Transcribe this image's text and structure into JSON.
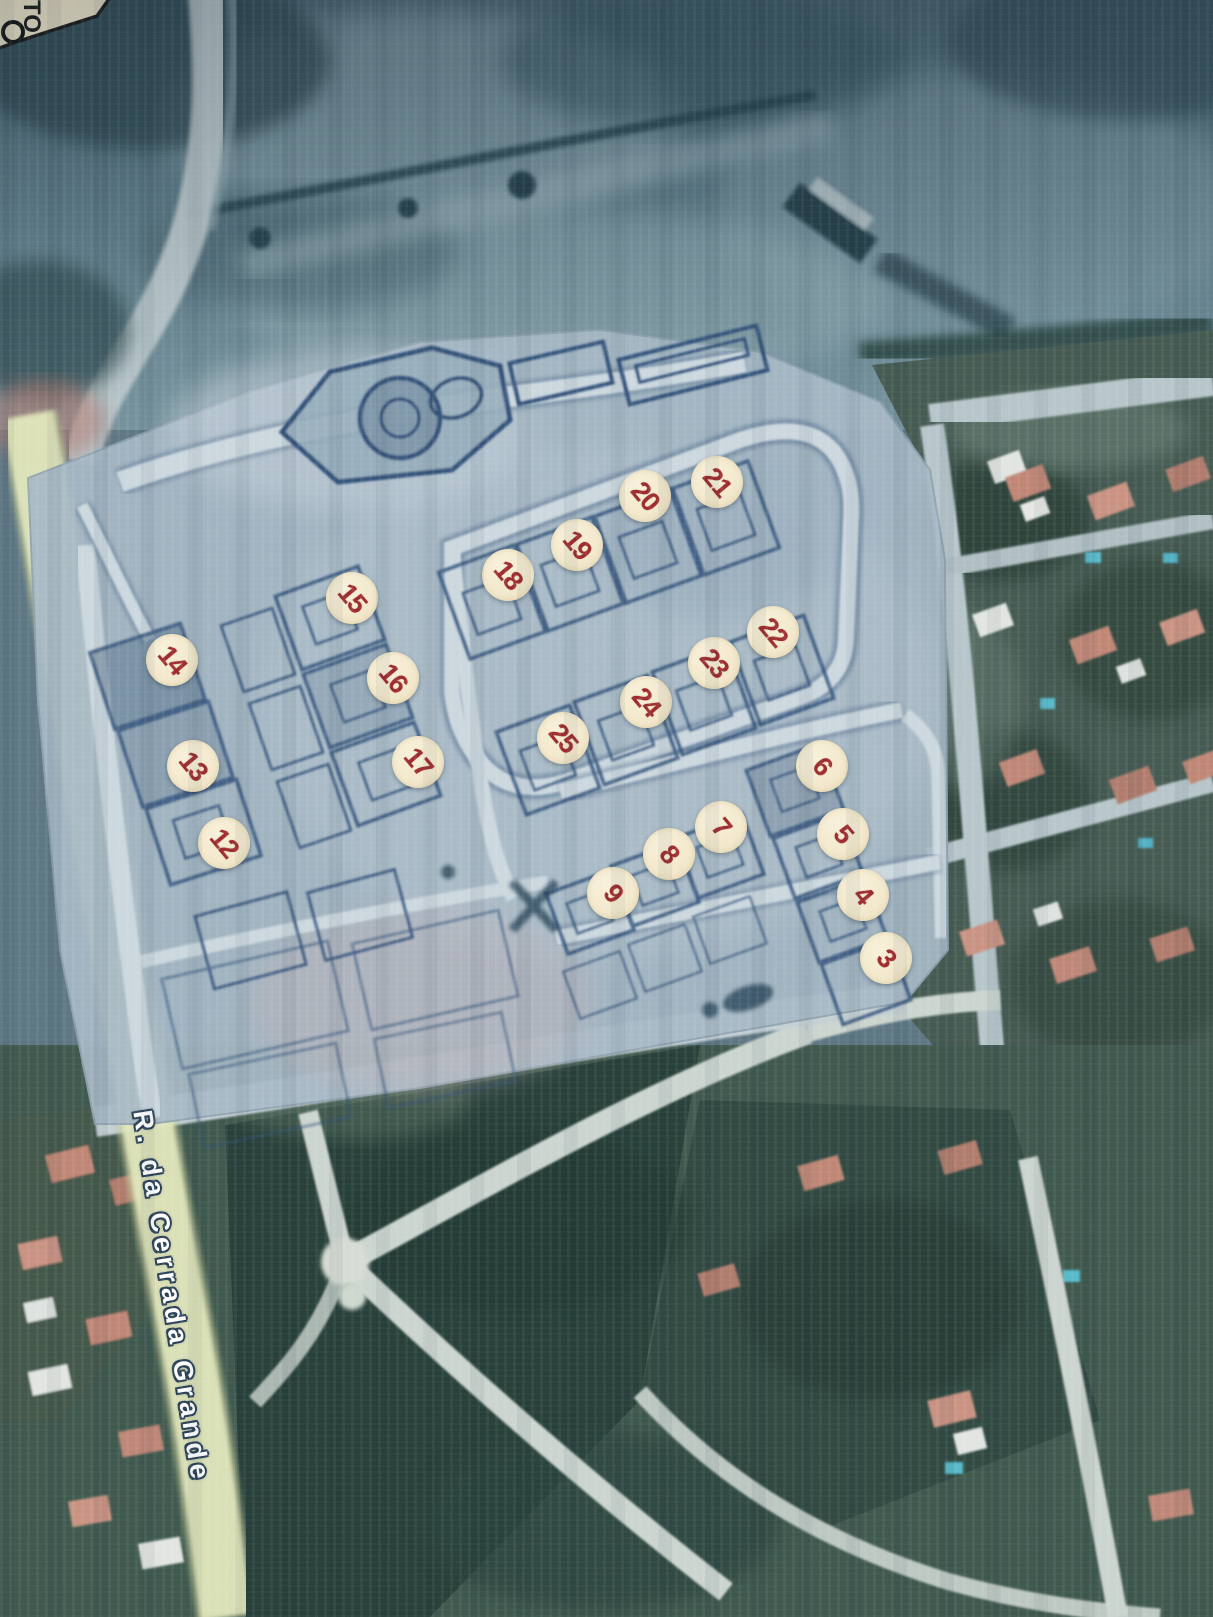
{
  "scene": {
    "description": "photograph of a printed aerial map with a development lot plan overlay and numbered lot stickers",
    "street_label": "R. da Cerrada Grande",
    "corner_text": "TO",
    "markers": [
      {
        "label": "3",
        "x": 886,
        "y": 958
      },
      {
        "label": "4",
        "x": 863,
        "y": 895
      },
      {
        "label": "5",
        "x": 843,
        "y": 834
      },
      {
        "label": "6",
        "x": 822,
        "y": 766
      },
      {
        "label": "7",
        "x": 721,
        "y": 827
      },
      {
        "label": "8",
        "x": 669,
        "y": 854
      },
      {
        "label": "9",
        "x": 613,
        "y": 893
      },
      {
        "label": "12",
        "x": 224,
        "y": 843
      },
      {
        "label": "13",
        "x": 193,
        "y": 766
      },
      {
        "label": "14",
        "x": 172,
        "y": 660
      },
      {
        "label": "15",
        "x": 352,
        "y": 598
      },
      {
        "label": "16",
        "x": 393,
        "y": 678
      },
      {
        "label": "17",
        "x": 418,
        "y": 762
      },
      {
        "label": "18",
        "x": 508,
        "y": 575
      },
      {
        "label": "19",
        "x": 577,
        "y": 545
      },
      {
        "label": "20",
        "x": 645,
        "y": 496
      },
      {
        "label": "21",
        "x": 717,
        "y": 482
      },
      {
        "label": "22",
        "x": 773,
        "y": 632
      },
      {
        "label": "23",
        "x": 714,
        "y": 663
      },
      {
        "label": "24",
        "x": 646,
        "y": 702
      },
      {
        "label": "25",
        "x": 563,
        "y": 738
      }
    ],
    "marker_style": {
      "diameter_px": 52,
      "fill": "#f3e9cd",
      "number_color": "#9e2c2e",
      "number_rotation_deg": 50,
      "highlight_glow": "#76ad68"
    },
    "street_label_style": {
      "color": "#ffffff",
      "outline_color": "#2b4257",
      "rotation_deg": 81
    },
    "palette": {
      "plan_background": "#a6b8c5",
      "plan_lot_line": "#2e4f78",
      "plan_road": "#ccd8df",
      "field_dark": "#3f5a66",
      "field_light": "#71909b",
      "residential_ground": "#42584f",
      "roof_salmon": "#c08573",
      "pool_turquoise": "#55b9ca",
      "road_pale": "#c0cdd2",
      "road_yellow_green": "#e1e6ba",
      "paper_corner": "#f0e7ca"
    }
  }
}
